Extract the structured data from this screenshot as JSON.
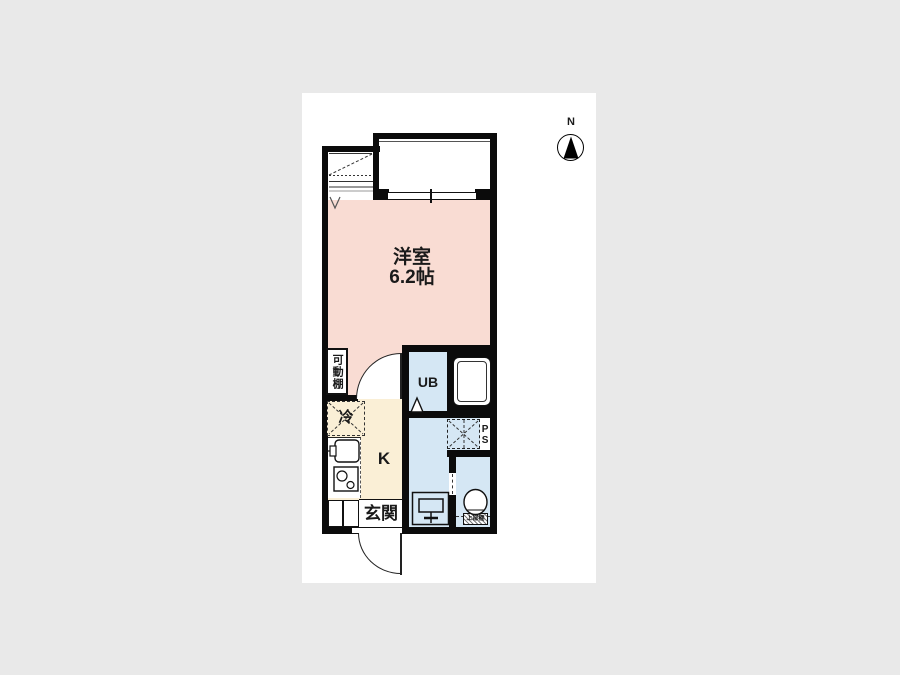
{
  "compass": {
    "north_label": "N"
  },
  "rooms": {
    "main": {
      "name": "洋室",
      "size": "6.2帖"
    },
    "kitchen": {
      "label": "K"
    },
    "unit_bath": {
      "label": "UB"
    },
    "pipe_space": {
      "label": "PS"
    },
    "entrance": {
      "label": "玄関"
    },
    "movable_shelf": {
      "label": "可動棚"
    },
    "refrigerator": {
      "label": "冷"
    },
    "toilet_upper_shelf": {
      "label": "上部棚"
    }
  },
  "colors": {
    "background": "#e9e9e9",
    "canvas": "#ffffff",
    "wall": "#0b0b0b",
    "main_room_pink": "#f9dcd3",
    "kitchen_cream": "#faefd6",
    "water_area_blue": "#d5e7f4"
  }
}
